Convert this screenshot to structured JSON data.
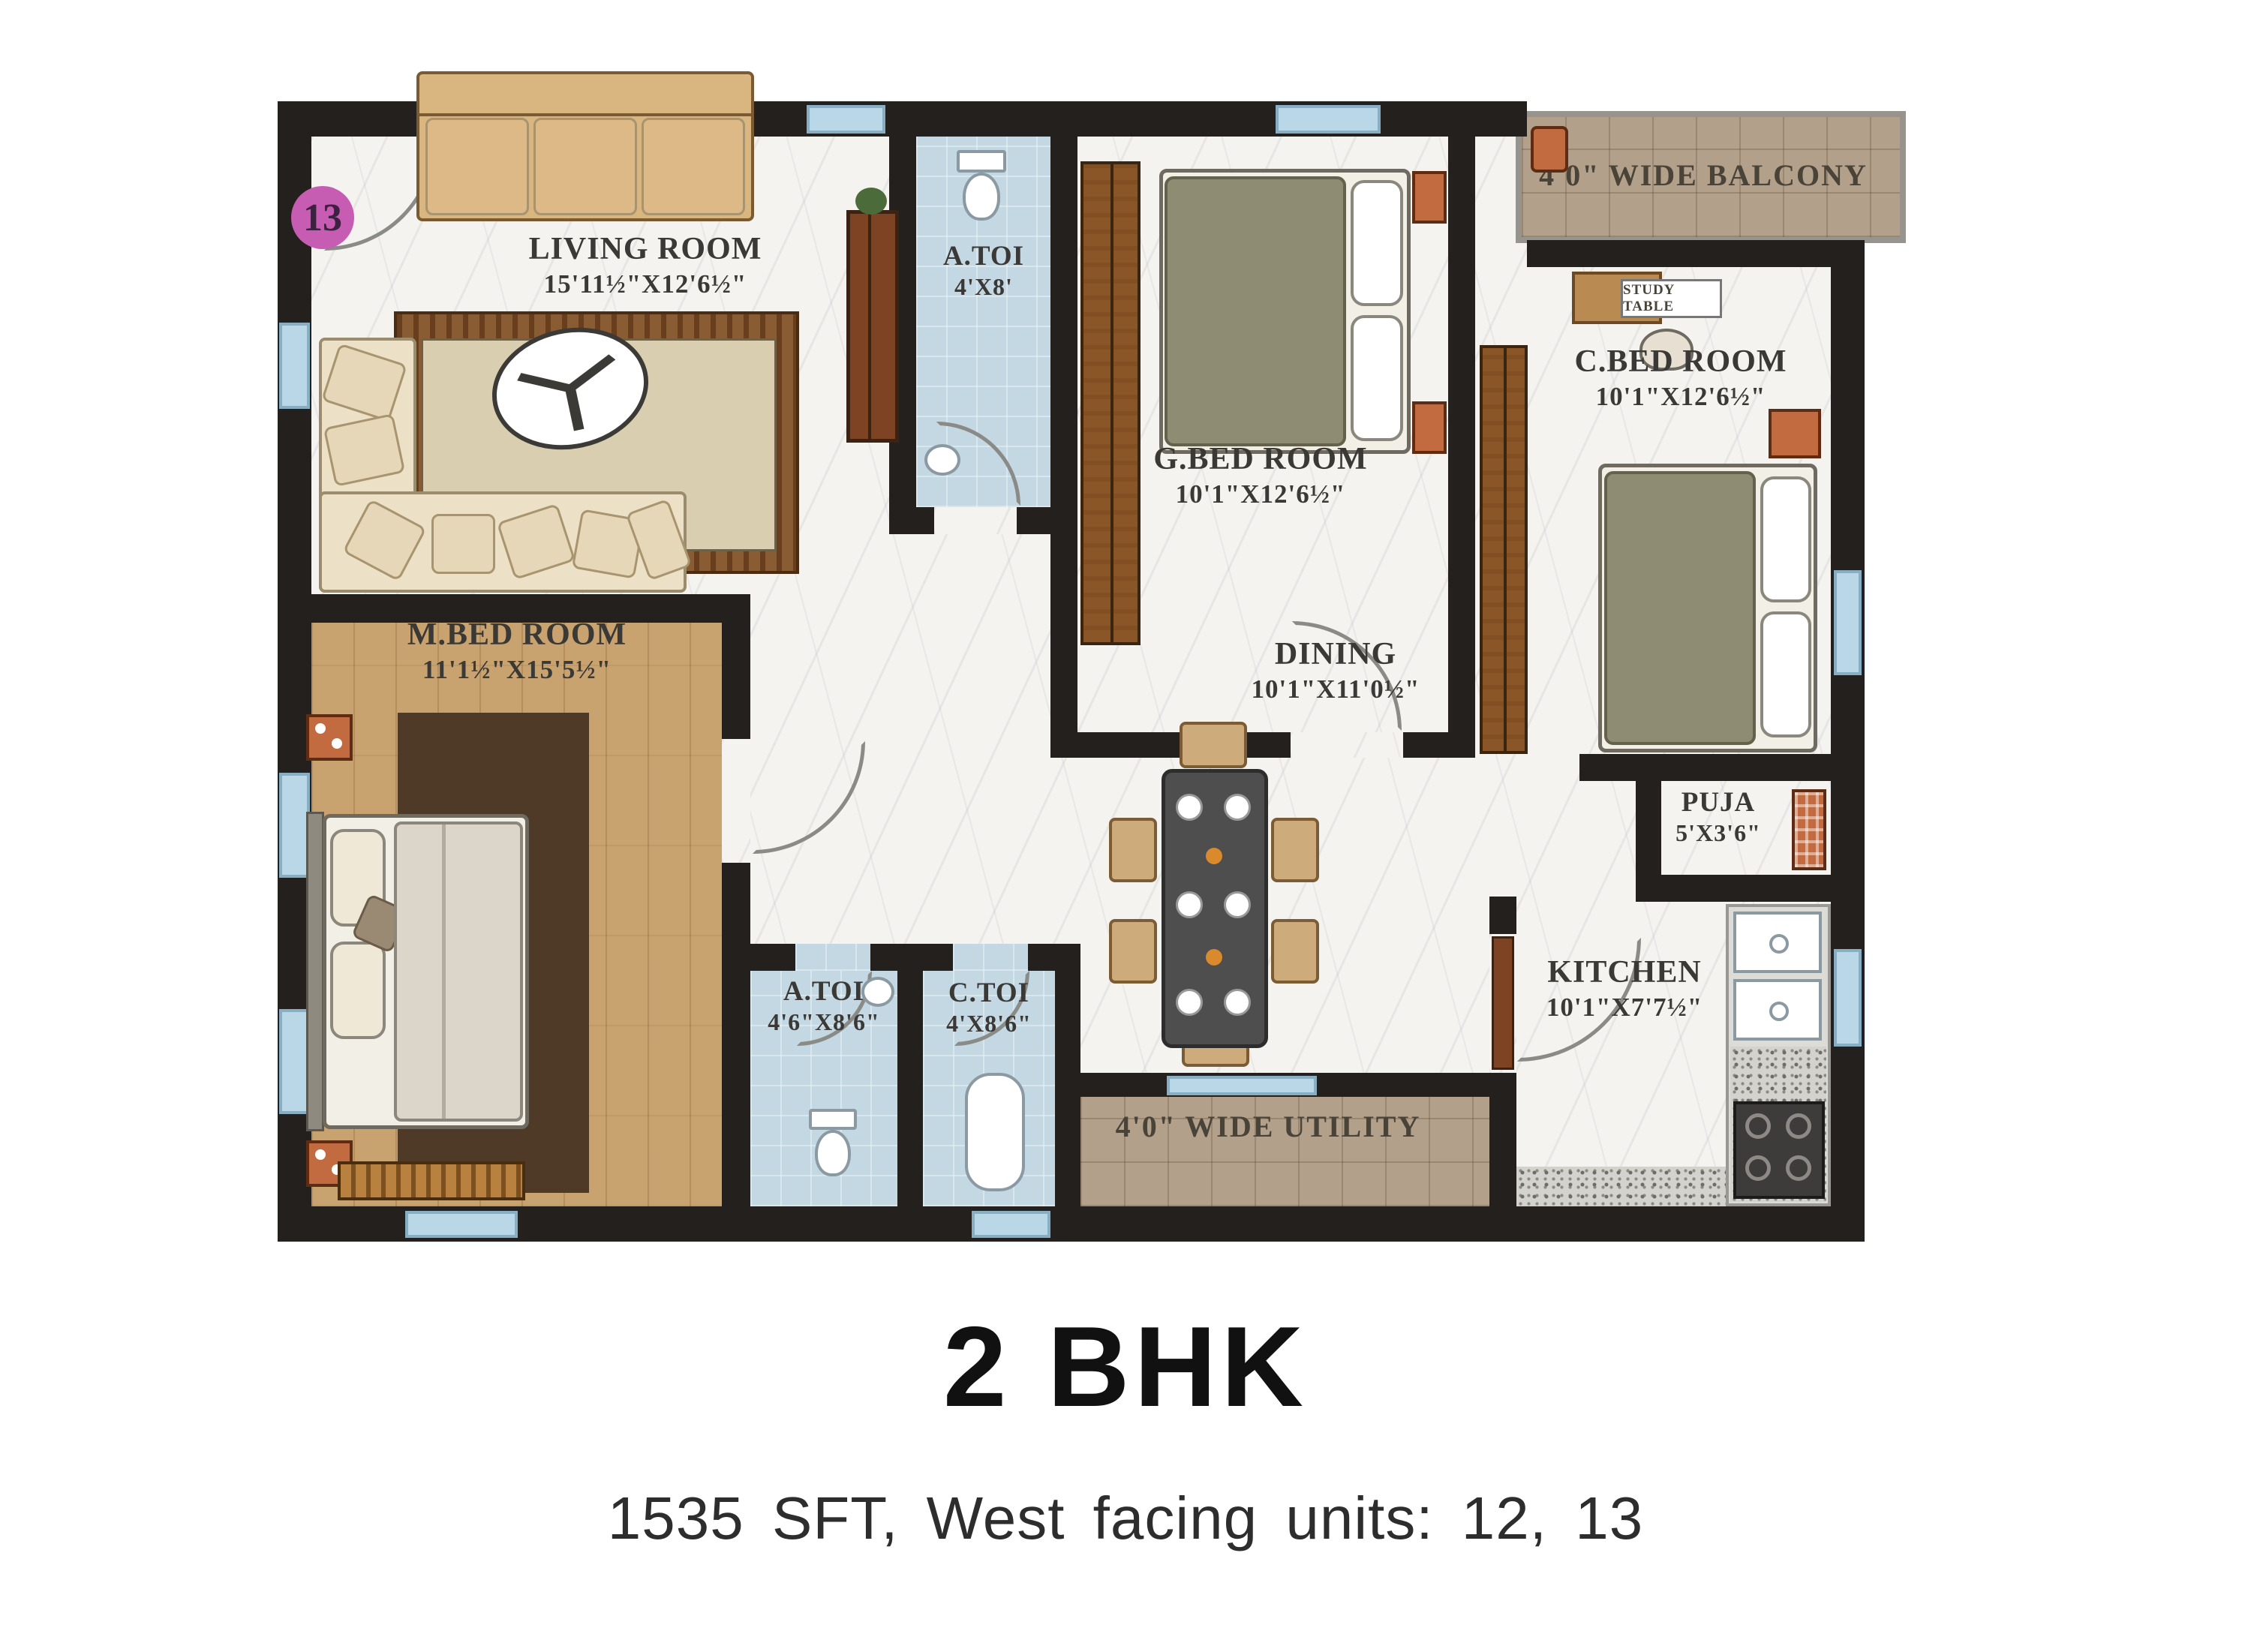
{
  "unit_badge": "13",
  "rooms": {
    "living": {
      "name": "LIVING ROOM",
      "dims": "15'11½\"X12'6½\""
    },
    "atoi_top": {
      "name": "A.TOI",
      "dims": "4'X8'"
    },
    "balcony": {
      "name": "4'0\" WIDE BALCONY"
    },
    "gbed": {
      "name": "G.BED ROOM",
      "dims": "10'1\"X12'6½\""
    },
    "cbed": {
      "name": "C.BED ROOM",
      "dims": "10'1\"X12'6½\""
    },
    "study_table": {
      "name": "STUDY TABLE"
    },
    "mbed": {
      "name": "M.BED ROOM",
      "dims": "11'1½\"X15'5½\""
    },
    "dining": {
      "name": "DINING",
      "dims": "10'1\"X11'0½\""
    },
    "puja": {
      "name": "PUJA",
      "dims": "5'X3'6\""
    },
    "atoi_bottom": {
      "name": "A.TOI",
      "dims": "4'6\"X8'6\""
    },
    "ctoi": {
      "name": "C.TOI",
      "dims": "4'X8'6\""
    },
    "kitchen": {
      "name": "KITCHEN",
      "dims": "10'1\"X7'7½\""
    },
    "utility": {
      "name": "4'0\" WIDE UTILITY"
    }
  },
  "footer": {
    "title": "2 BHK",
    "subtitle": "1535 SFT, West facing units: 12, 13"
  },
  "colors": {
    "wall": "#23201d",
    "marble": "#f4f3f0",
    "wood": "#c9a36f",
    "toilet_blue": "#c3d8e3",
    "tile_tan": "#b2a08b",
    "badge_pink": "#c75cb3",
    "accent_orange": "#c26b41"
  }
}
